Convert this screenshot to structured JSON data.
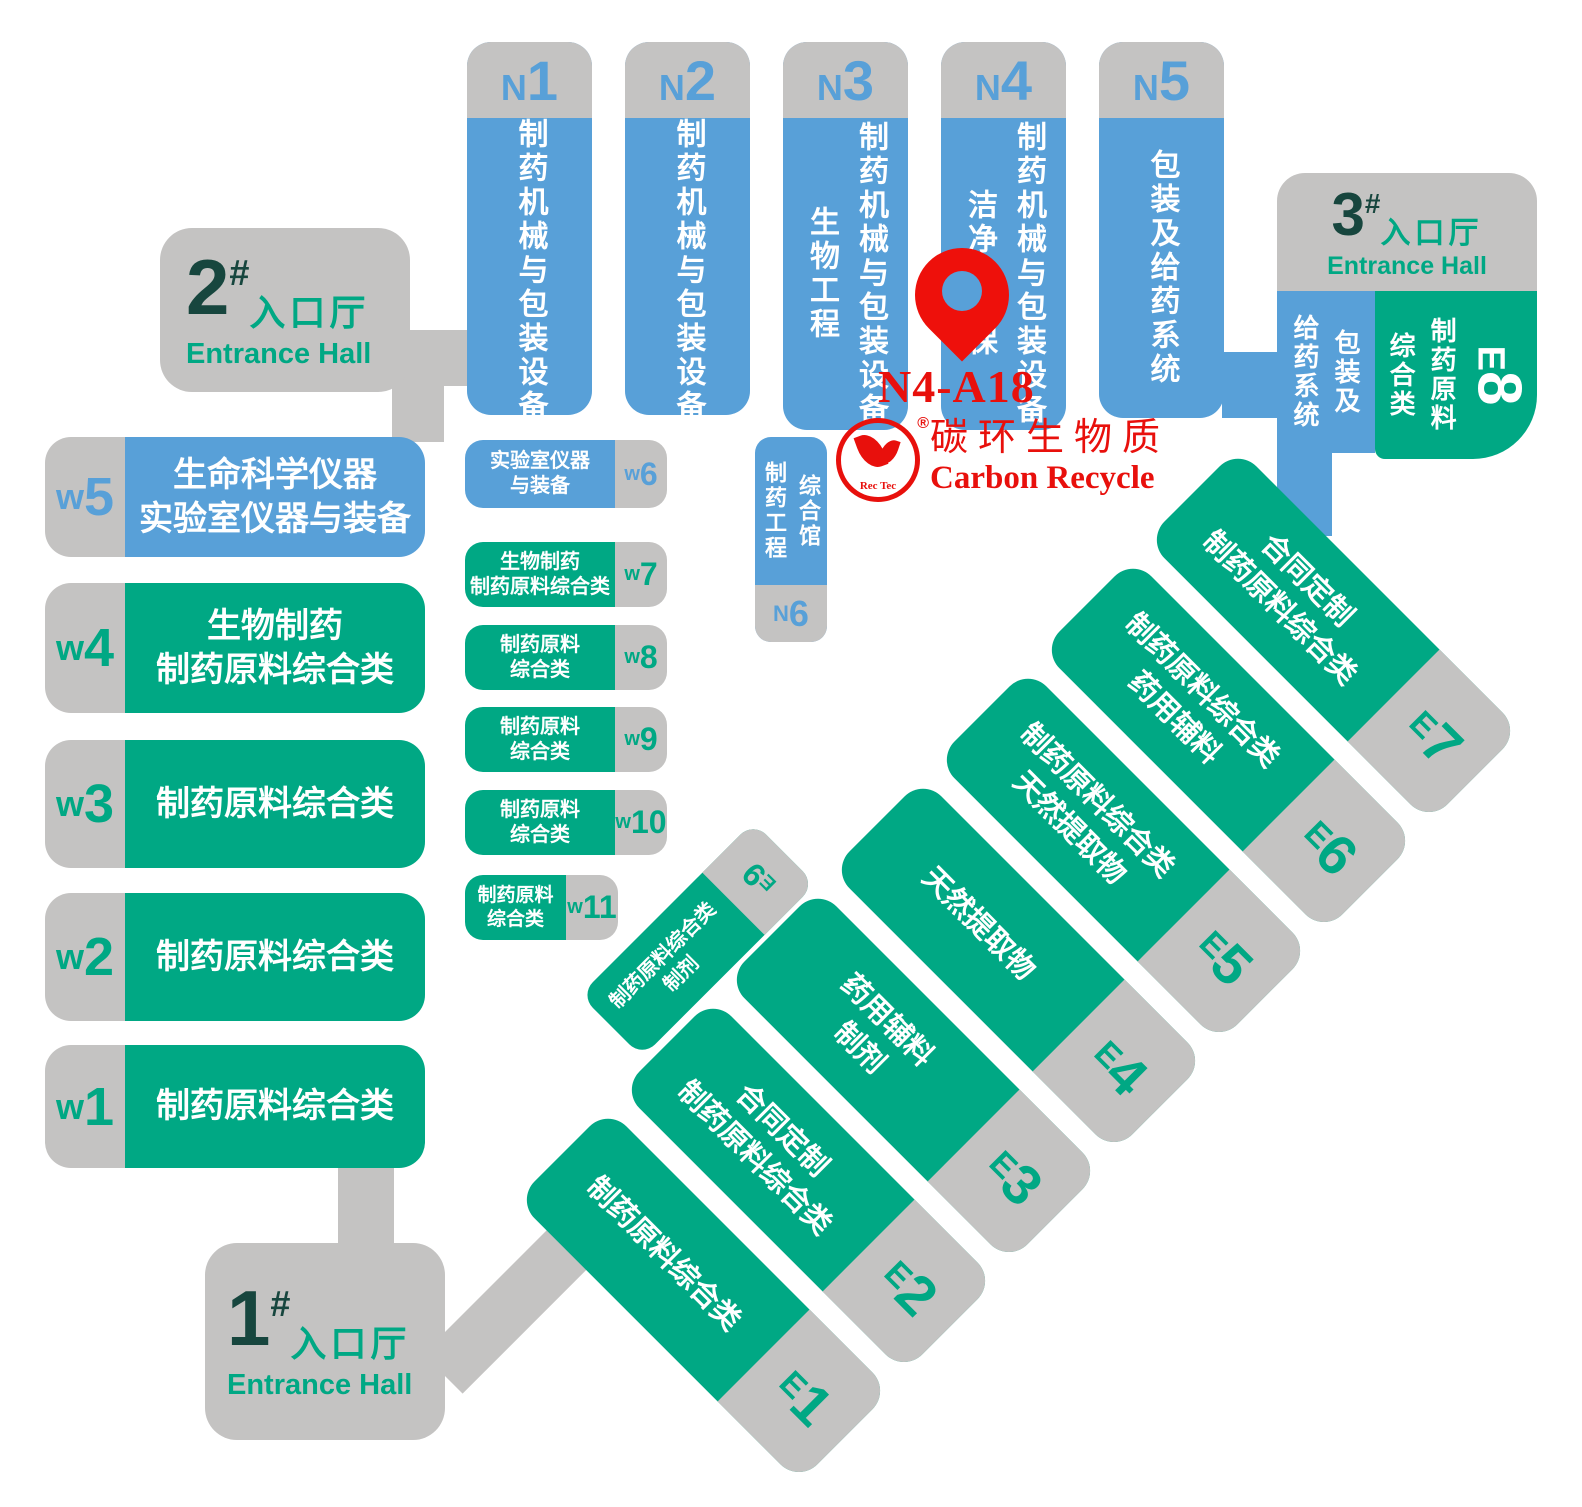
{
  "colors": {
    "hall_blue": "#58A0D8",
    "hall_green": "#00A884",
    "connector_gray": "#C4C3C2",
    "entrance_number_dark": "#17463E",
    "entrance_text_green": "#00A884",
    "marker_red": "#E8100C"
  },
  "pin": {
    "booth": "N4-A18"
  },
  "logo": {
    "cn": "碳环生物质",
    "en": "Carbon Recycle",
    "badge": "Rec Tec",
    "reg": "®"
  },
  "entrances": {
    "h1": {
      "num": "1",
      "hash": "#",
      "cn": "入口厅",
      "en": "Entrance Hall"
    },
    "h2": {
      "num": "2",
      "hash": "#",
      "cn": "入口厅",
      "en": "Entrance Hall"
    },
    "h3": {
      "num": "3",
      "hash": "#",
      "cn": "入口厅",
      "en": "Entrance Hall"
    }
  },
  "north": [
    {
      "letter": "N",
      "digit": "1",
      "cols": [
        "制药机械与包装设备"
      ]
    },
    {
      "letter": "N",
      "digit": "2",
      "cols": [
        "制药机械与包装设备"
      ]
    },
    {
      "letter": "N",
      "digit": "3",
      "cols": [
        "生物工程",
        "制药机械与包装设备"
      ]
    },
    {
      "letter": "N",
      "digit": "4",
      "cols": [
        "洁净与环保",
        "制药机械与包装设备"
      ]
    },
    {
      "letter": "N",
      "digit": "5",
      "cols": [
        "包装及给药系统"
      ]
    }
  ],
  "n6": {
    "letter": "N",
    "digit": "6",
    "cols": [
      "制药工程",
      "综合馆"
    ]
  },
  "west": [
    {
      "letter": "w",
      "digit": "5",
      "lines": [
        "生命科学仪器",
        "实验室仪器与装备"
      ]
    },
    {
      "letter": "w",
      "digit": "4",
      "lines": [
        "生物制药",
        "制药原料综合类"
      ]
    },
    {
      "letter": "w",
      "digit": "3",
      "lines": [
        "制药原料综合类"
      ]
    },
    {
      "letter": "w",
      "digit": "2",
      "lines": [
        "制药原料综合类"
      ]
    },
    {
      "letter": "w",
      "digit": "1",
      "lines": [
        "制药原料综合类"
      ]
    }
  ],
  "west_small": [
    {
      "letter": "w",
      "digit": "6",
      "lines": [
        "实验室仪器",
        "与装备"
      ]
    },
    {
      "letter": "w",
      "digit": "7",
      "lines": [
        "生物制药",
        "制药原料综合类"
      ]
    },
    {
      "letter": "w",
      "digit": "8",
      "lines": [
        "制药原料",
        "综合类"
      ]
    },
    {
      "letter": "w",
      "digit": "9",
      "lines": [
        "制药原料",
        "综合类"
      ]
    },
    {
      "letter": "w",
      "digit": "10",
      "lines": [
        "制药原料",
        "综合类"
      ]
    },
    {
      "letter": "w",
      "digit": "11",
      "lines": [
        "制药原料",
        "综合类"
      ]
    }
  ],
  "east": [
    {
      "letter": "E",
      "digit": "7",
      "lines": [
        "合同定制",
        "制药原料综合类"
      ]
    },
    {
      "letter": "E",
      "digit": "6",
      "lines": [
        "制药原料综合类",
        "药用辅料"
      ]
    },
    {
      "letter": "E",
      "digit": "5",
      "lines": [
        "制药原料综合类",
        "天然提取物"
      ]
    },
    {
      "letter": "E",
      "digit": "4",
      "lines": [
        "天然提取物"
      ]
    },
    {
      "letter": "E",
      "digit": "3",
      "lines": [
        "药用辅料",
        "制剂"
      ]
    },
    {
      "letter": "E",
      "digit": "2",
      "lines": [
        "合同定制",
        "制药原料综合类"
      ]
    },
    {
      "letter": "E",
      "digit": "1",
      "lines": [
        "制药原料综合类"
      ]
    }
  ],
  "e9": {
    "letter": "E",
    "digit": "9",
    "lines": [
      "制药原料综合类",
      "制剂"
    ]
  },
  "e8": {
    "letter": "E",
    "digit": "8",
    "blue_cols": [
      "给药系统",
      "包装及"
    ],
    "green_cols": [
      "综合类",
      "制药原料"
    ]
  }
}
